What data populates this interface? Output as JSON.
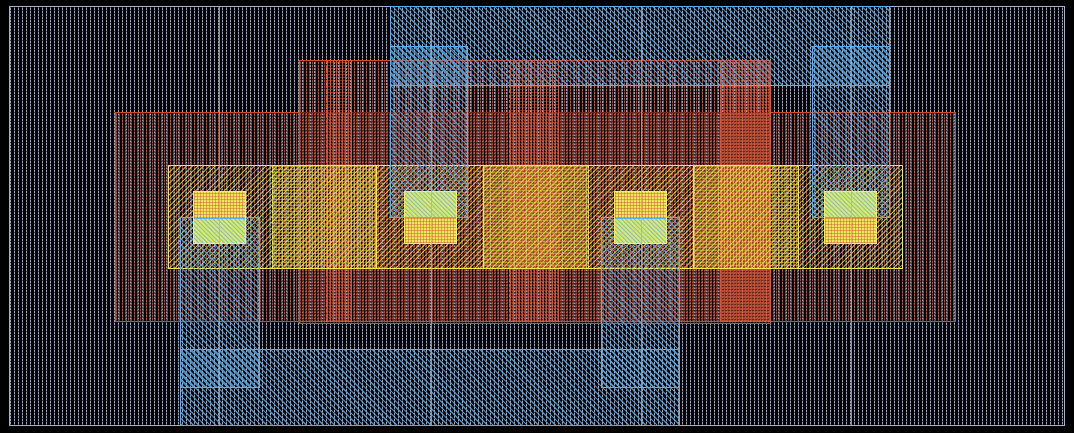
{
  "canvas": {
    "width": 1074,
    "height": 433,
    "background": "#000000",
    "description": "IC mask layout viewer canvas, no visible text"
  },
  "palette": {
    "substrate_hatch": "#99a1b8",
    "substrate_outline": "#a9b2c8",
    "poly_hatch": "#c54e36",
    "poly_outline": "#d04828",
    "gate_outline": "#e25532",
    "metal_hatch": "#58a9e3",
    "metal_outline": "#5cb0f0",
    "active_hatch": "#f0e546",
    "active_outline": "#f2ea4c",
    "contact_warm": "#f0e65a",
    "contact_green": "#d9e870",
    "tile_grid_line": "#a8b1ca"
  },
  "rects": [
    {
      "name": "substrate-well-region",
      "layer": "substrate",
      "x": 9,
      "y": 6,
      "w": 1056,
      "h": 420
    },
    {
      "name": "implant-outer-region",
      "layer": "poly",
      "x": 115,
      "y": 112,
      "w": 841,
      "h": 210
    },
    {
      "name": "implant-inner-region",
      "layer": "poly",
      "x": 299,
      "y": 60,
      "w": 472,
      "h": 264
    },
    {
      "name": "poly-gate-strip-1",
      "layer": "gate",
      "x": 326,
      "y": 60,
      "w": 26,
      "h": 262
    },
    {
      "name": "poly-gate-strip-2",
      "layer": "gate",
      "x": 509,
      "y": 60,
      "w": 50,
      "h": 262
    },
    {
      "name": "poly-gate-strip-3",
      "layer": "gate",
      "x": 720,
      "y": 60,
      "w": 51,
      "h": 262
    },
    {
      "name": "active-diffusion-band",
      "layer": "active",
      "x": 168,
      "y": 165,
      "w": 735,
      "h": 104
    },
    {
      "name": "gate-active-overlap-1",
      "layer": "active-dense",
      "x": 272,
      "y": 165,
      "w": 105,
      "h": 104,
      "extra": "dash-left"
    },
    {
      "name": "gate-active-overlap-2",
      "layer": "active-dense",
      "x": 483,
      "y": 165,
      "w": 106,
      "h": 104,
      "extra": "dash-right"
    },
    {
      "name": "gate-active-overlap-3",
      "layer": "active-dense",
      "x": 693,
      "y": 165,
      "w": 106,
      "h": 104
    },
    {
      "name": "metal-top-rail",
      "layer": "metal",
      "x": 390,
      "y": 6,
      "w": 500,
      "h": 80
    },
    {
      "name": "metal-bottom-rail",
      "layer": "metal",
      "x": 180,
      "y": 349,
      "w": 500,
      "h": 77
    },
    {
      "name": "metal-via-column-1",
      "layer": "metal",
      "x": 180,
      "y": 217,
      "w": 80,
      "h": 171
    },
    {
      "name": "metal-via-column-2",
      "layer": "metal",
      "x": 390,
      "y": 46,
      "w": 78,
      "h": 172
    },
    {
      "name": "metal-via-column-3",
      "layer": "metal",
      "x": 601,
      "y": 217,
      "w": 79,
      "h": 171
    },
    {
      "name": "metal-via-column-4",
      "layer": "metal",
      "x": 812,
      "y": 46,
      "w": 78,
      "h": 172
    }
  ],
  "contacts": [
    {
      "name": "contact-1",
      "x": 193,
      "y": 191,
      "w": 53,
      "h": 53,
      "metal_overlap": "bottom"
    },
    {
      "name": "contact-2",
      "x": 404,
      "y": 191,
      "w": 53,
      "h": 53,
      "metal_overlap": "top"
    },
    {
      "name": "contact-3",
      "x": 614,
      "y": 191,
      "w": 53,
      "h": 53,
      "metal_overlap": "bottom"
    },
    {
      "name": "contact-4",
      "x": 824,
      "y": 191,
      "w": 53,
      "h": 53,
      "metal_overlap": "top"
    }
  ],
  "tile_grid": {
    "xs": [
      219,
      431,
      641,
      851
    ],
    "y": 6,
    "h": 420
  }
}
